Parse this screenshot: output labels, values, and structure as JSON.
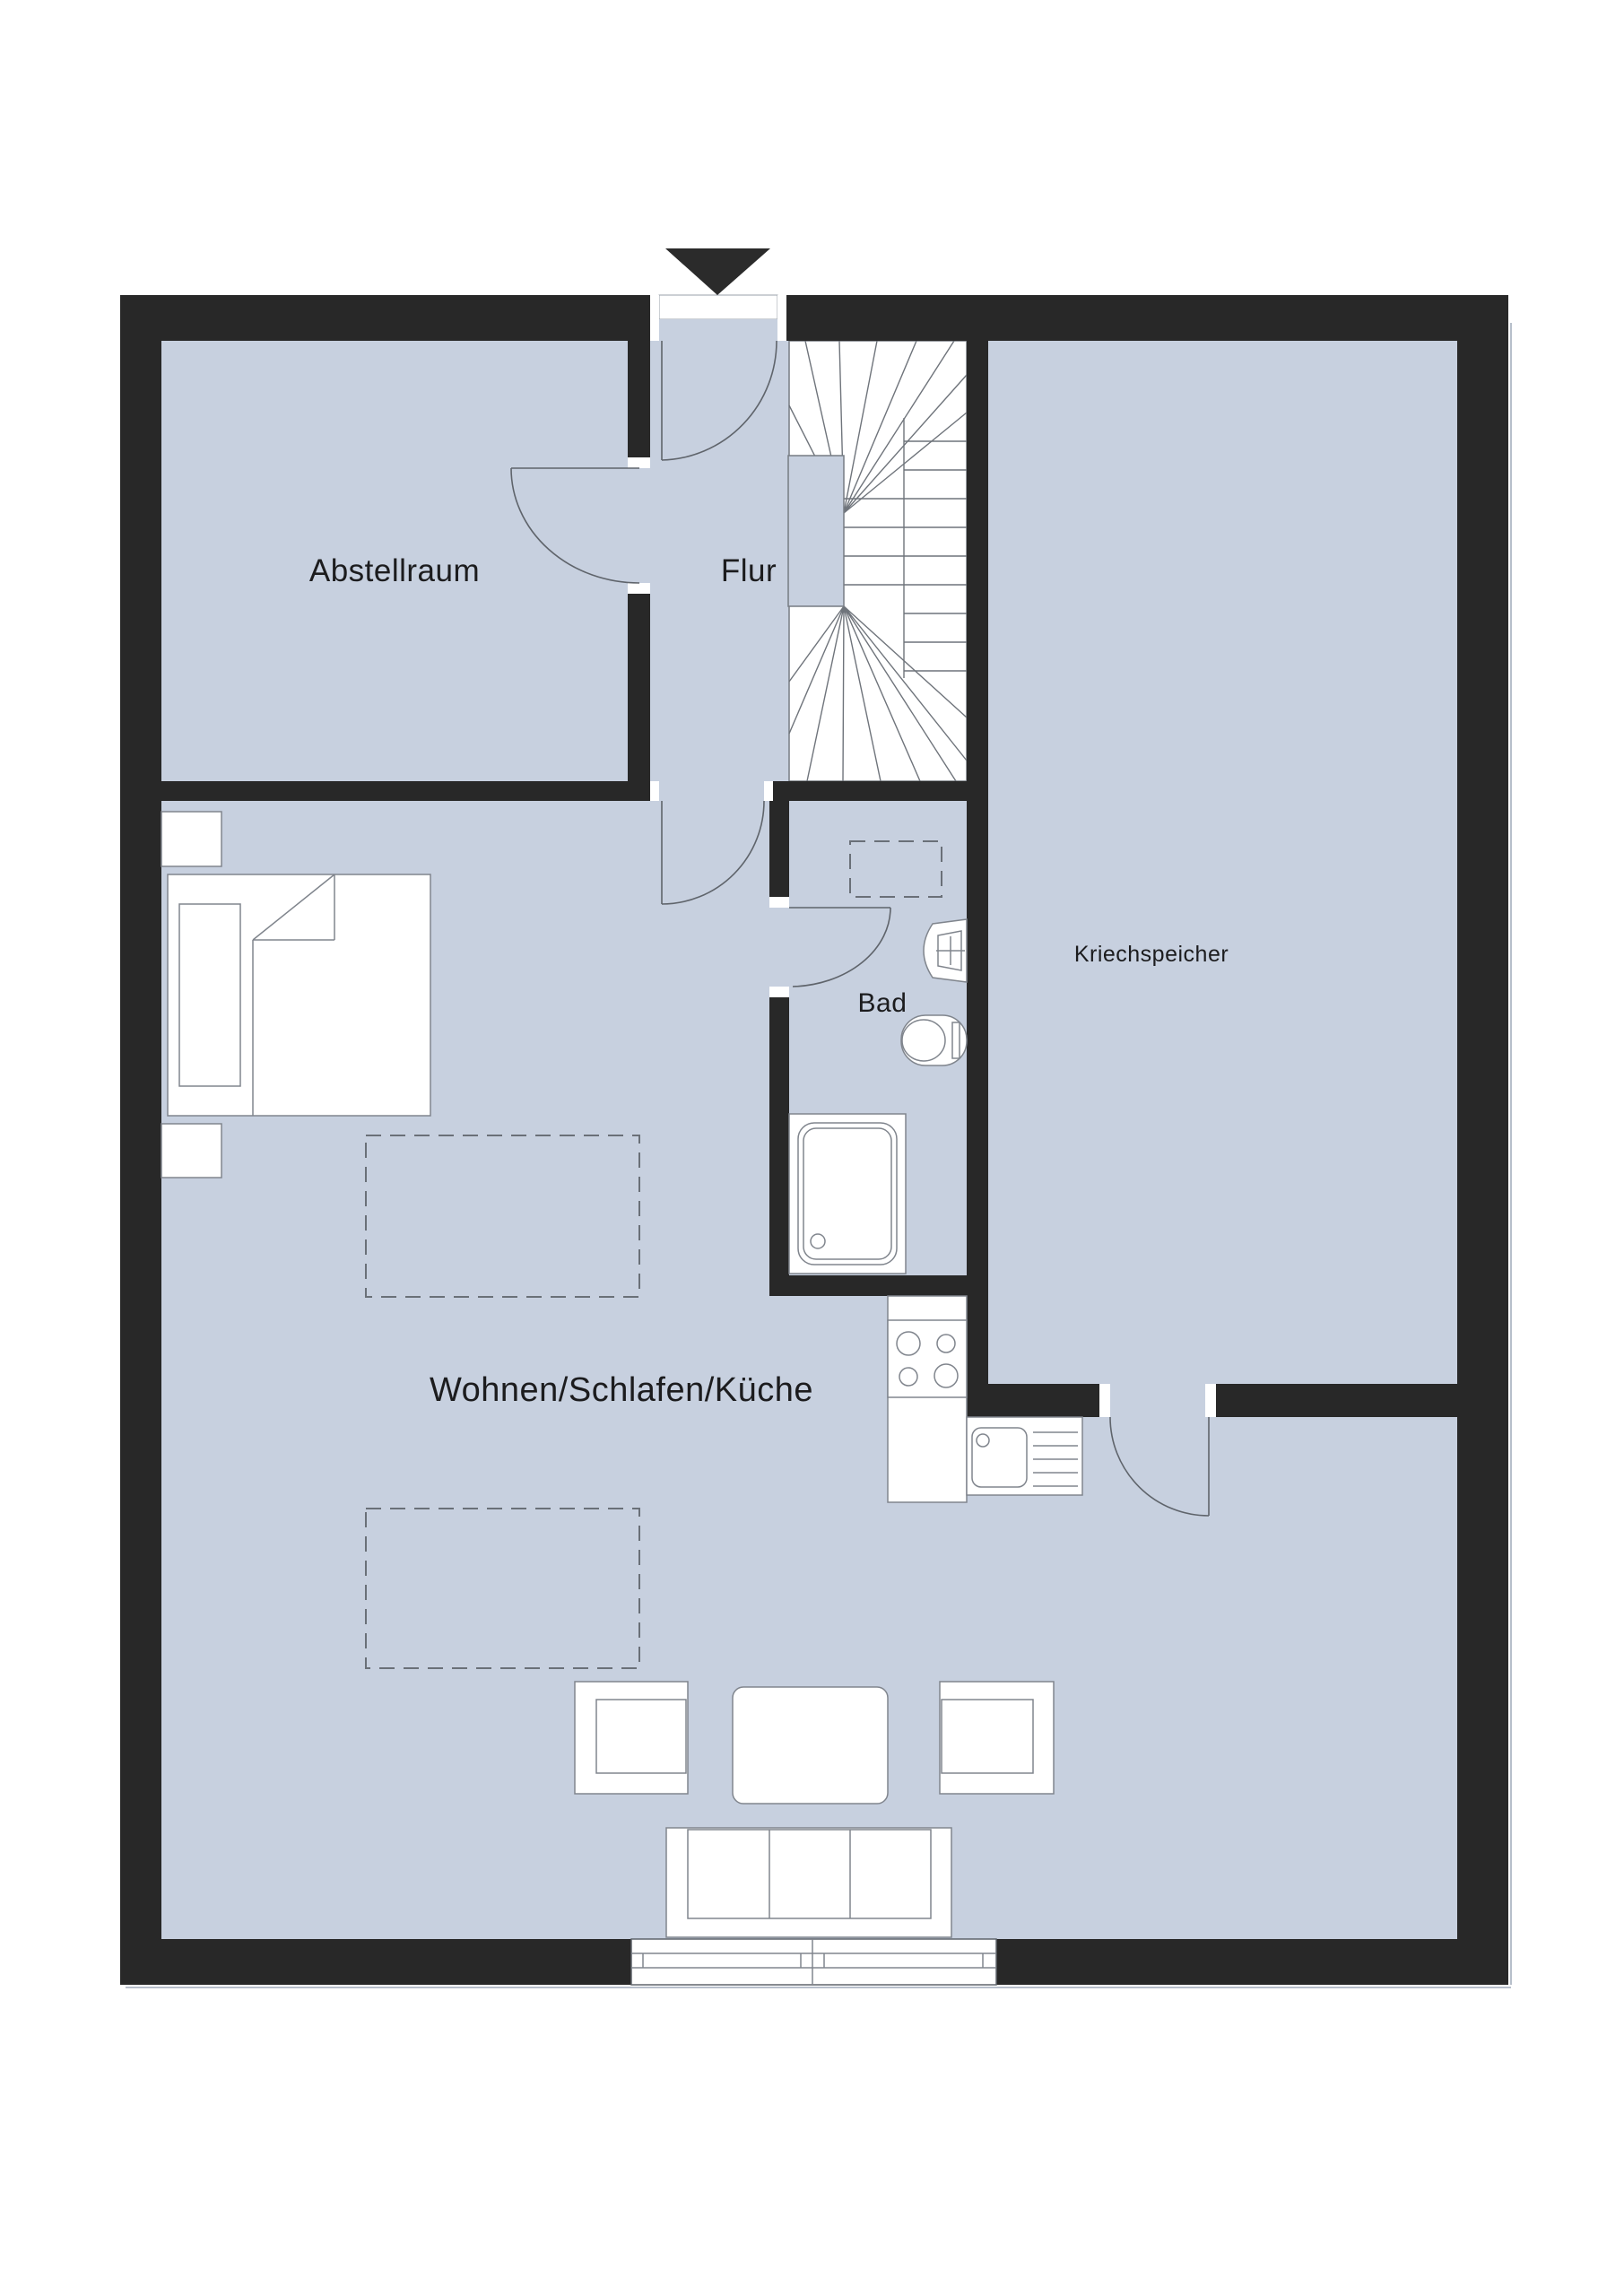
{
  "floorplan": {
    "type": "apartment-floor-plan-attic-storey",
    "labels": {
      "abstellraum": "Abstellraum",
      "flur": "Flur",
      "kriechspeicher": "Kriechspeicher",
      "bad": "Bad",
      "wohnen": "Wohnen/Schlafen/Küche"
    },
    "colors": {
      "wall": "#282828",
      "floor": "#c7d0df",
      "furniture_outline": "#80858d",
      "background": "#ffffff",
      "text": "#1c1c1e"
    },
    "symbols": [
      "entrance-arrow",
      "entrance-door-swing",
      "winder-staircase",
      "storage-room-door-swing",
      "living-room-door-swing",
      "bathroom-door-swing",
      "crawl-attic-door-swing",
      "roof-window-dashed-bath",
      "roof-window-dashed-living-1",
      "roof-window-dashed-living-2",
      "double-bed-with-pillow-and-blanket",
      "nightstand-upper",
      "nightstand-lower",
      "washbasin",
      "toilet",
      "shower-tray",
      "kitchen-counter-with-stove",
      "kitchen-sink-with-drainboard",
      "armchair-left",
      "coffee-table",
      "armchair-right",
      "sofa-three-seat",
      "bottom-window"
    ]
  }
}
